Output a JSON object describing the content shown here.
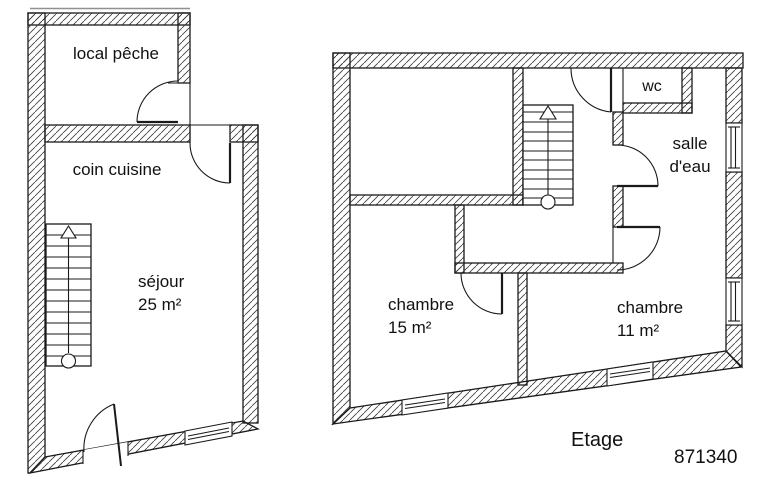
{
  "plan": {
    "type": "architectural-floor-plan",
    "ground_floor": {
      "rooms": {
        "local_peche": {
          "label": "local pêche"
        },
        "coin_cuisine": {
          "label": "coin cuisine"
        },
        "sejour": {
          "label": "séjour",
          "area": "25 m²"
        }
      }
    },
    "upper_floor": {
      "floor_label": "Etage",
      "rooms": {
        "wc": {
          "label": "wc"
        },
        "salle_eau": {
          "line1": "salle",
          "line2": "d'eau"
        },
        "chambre_grande": {
          "label": "chambre",
          "area": "15 m²"
        },
        "chambre_petite": {
          "label": "chambre",
          "area": "11 m²"
        }
      }
    },
    "reference": "871340"
  },
  "colors": {
    "line": "#1a1a1a",
    "hatch": "#3c3c3c",
    "background": "#ffffff",
    "text": "#111111",
    "faint": "#909090"
  }
}
